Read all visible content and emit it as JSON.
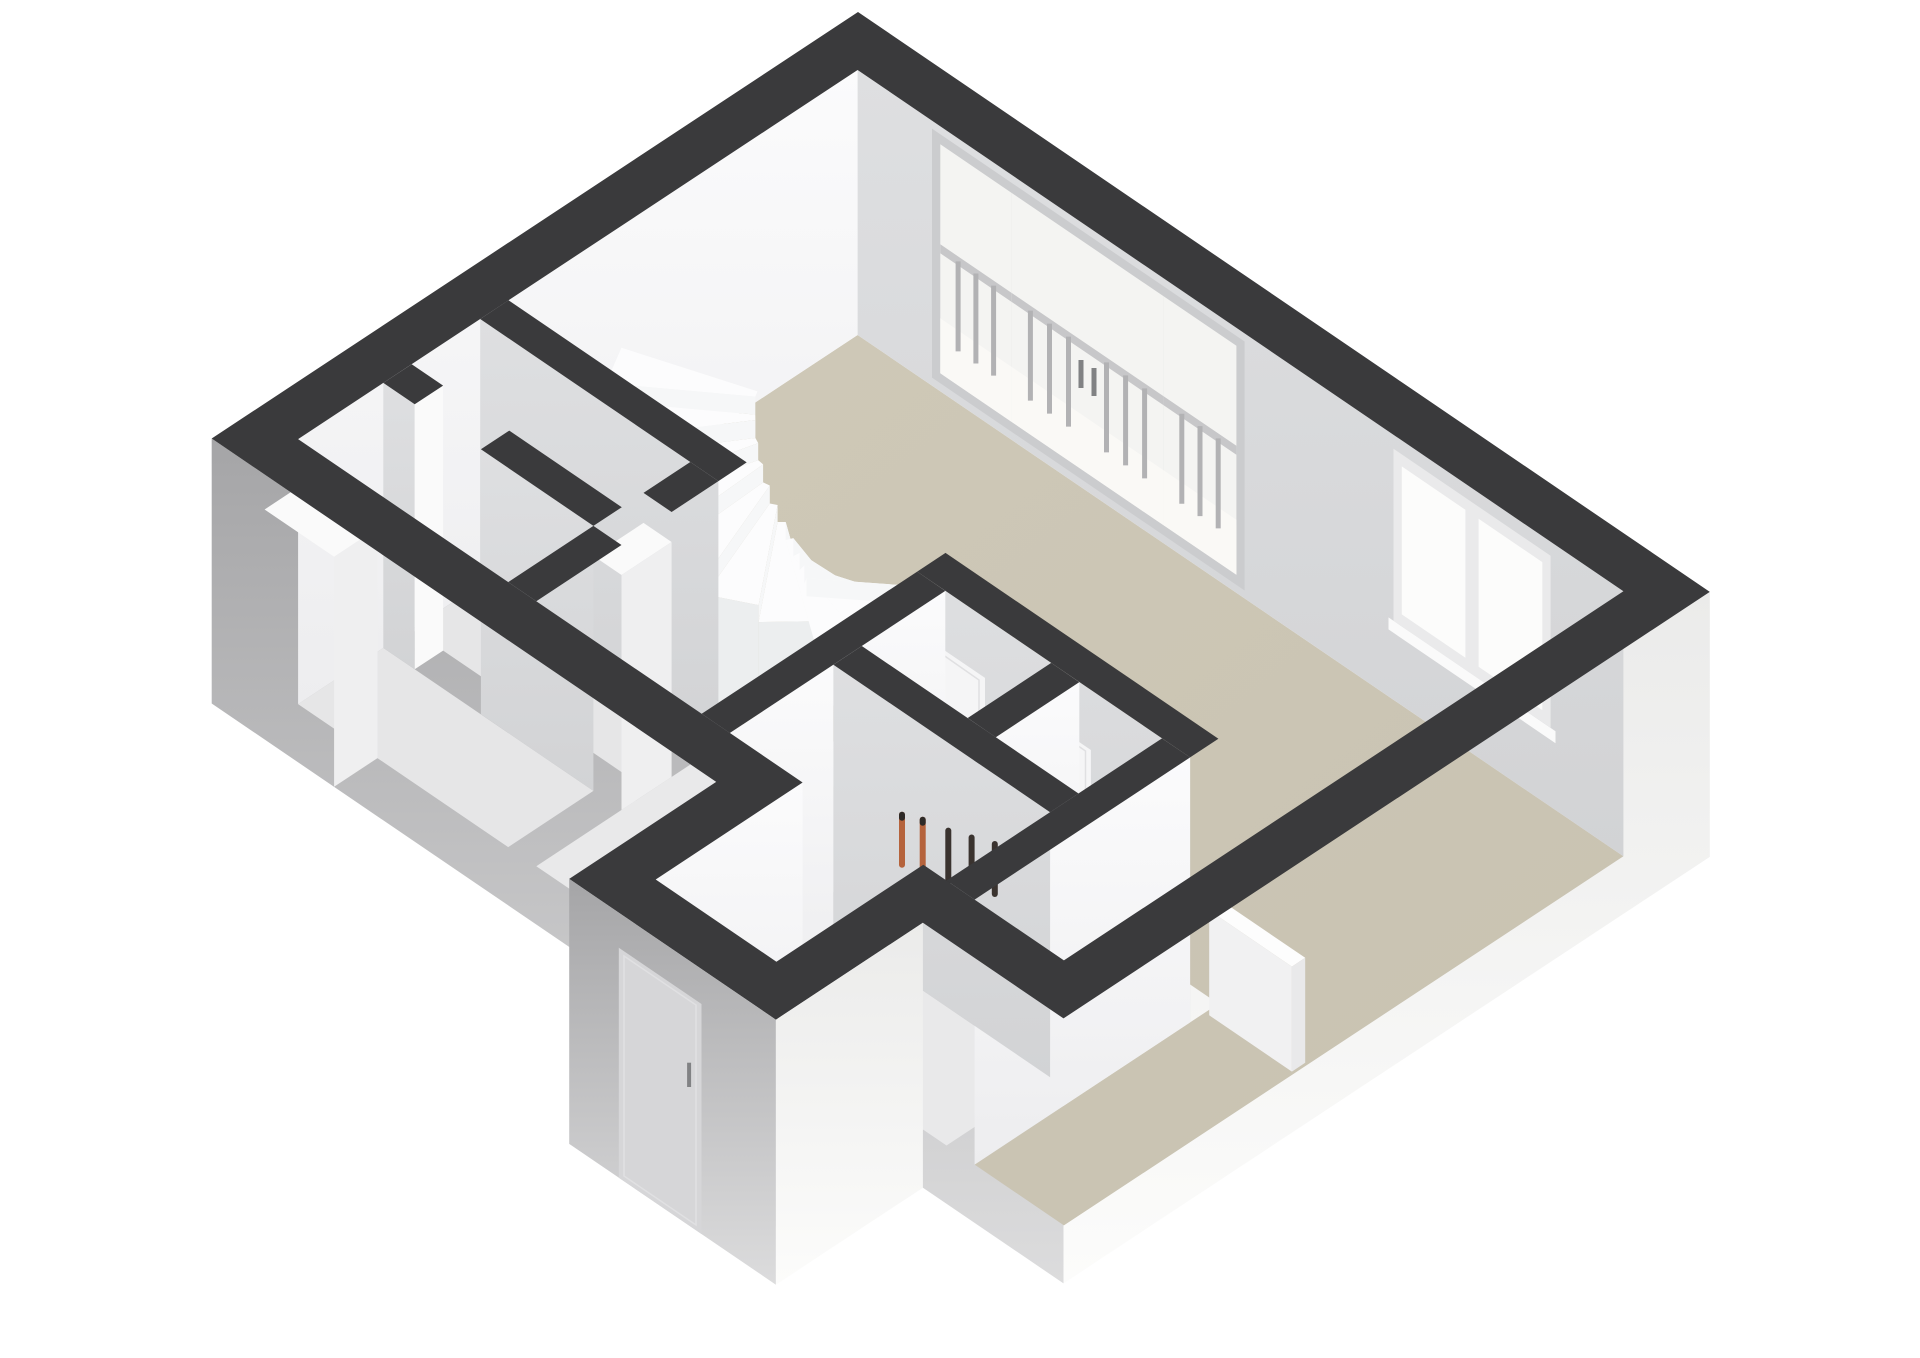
{
  "scene": {
    "type": "3d-floorplan-isometric",
    "background": "#ffffff",
    "colors": {
      "wall_top": "#3a3a3c",
      "ext_gray_top": "#a5a5a7",
      "ext_gray_bottom": "#dcdcdd",
      "ext_bright_top": "#ebebea",
      "ext_bright_bottom": "#fcfcfb",
      "int_bright_top": "#fbfbfc",
      "int_bright_bottom": "#ededef",
      "int_gray_top": "#dedfe1",
      "int_gray_bottom": "#d2d3d5",
      "floor_main_1": "#cfc9b8",
      "floor_main_2": "#c8c2b1",
      "floor_light": "#e9e9ea",
      "floor_closet": "#e6e6e7",
      "glass": "#f4f4f2",
      "frame": "#cbccce",
      "frame_light": "#eaeaeb",
      "pane": "#fcfcfb",
      "balcony_floor": "#faf9f6",
      "baluster": "#b2b2b4",
      "rail": "#c7c7c9",
      "handle": "#818284",
      "stair_top": "#fcfcfd",
      "stair_riser": "#f6f7f8",
      "stair_side": "#eceeef",
      "stair_side_lit": "#f3f4f5",
      "door": "#f5f5f6",
      "door_frame": "#e0e0e2",
      "door_ext": "#d6d6d8",
      "white": "#fafafa",
      "slab_side": "#efeff0",
      "pipe_dark": "#3a332f",
      "pipe_orange": "#b5633c",
      "pipe_cap": "#2e2a27",
      "radiator_top": "#fdfdfd",
      "radiator_front": "#f1f1f2",
      "radiator_end": "#e9e9ea"
    },
    "features": [
      {
        "name": "exterior-walls"
      },
      {
        "name": "living-room-floor"
      },
      {
        "name": "hall-floor"
      },
      {
        "name": "winder-staircase"
      },
      {
        "name": "balcony-glass-doors"
      },
      {
        "name": "balcony-railing"
      },
      {
        "name": "right-window"
      },
      {
        "name": "storage-closets"
      },
      {
        "name": "meter-cupboard-pipes"
      },
      {
        "name": "interior-doors"
      },
      {
        "name": "front-door"
      },
      {
        "name": "radiator"
      },
      {
        "name": "entry-vestibule"
      }
    ]
  }
}
